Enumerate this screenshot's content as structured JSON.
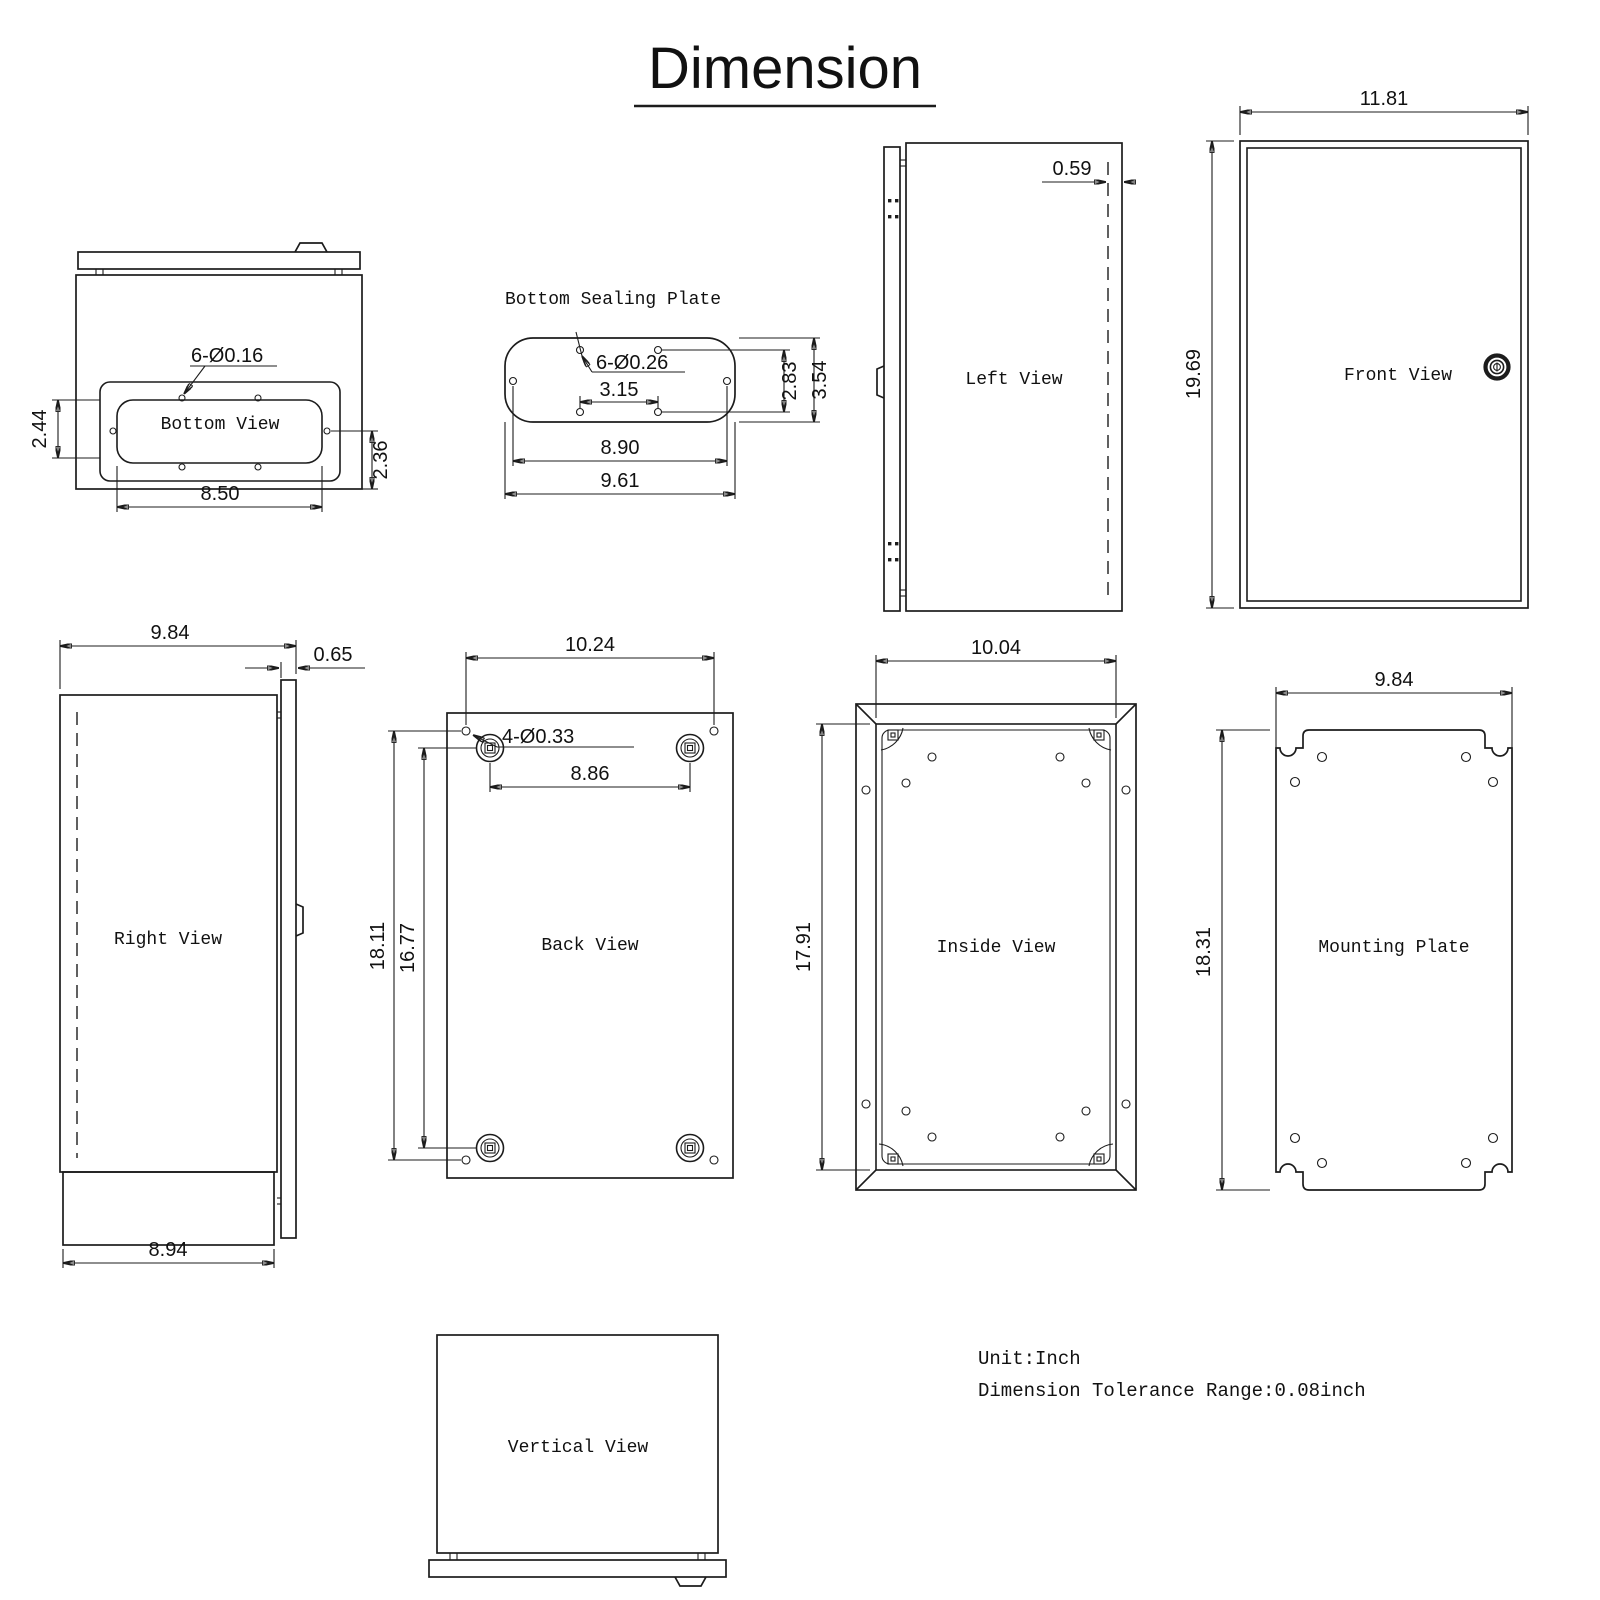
{
  "title": "Dimension",
  "notes": {
    "unit": "Unit:Inch",
    "tolerance": "Dimension Tolerance Range:0.08inch"
  },
  "icons": {
    "front_lock": "cam-lock-icon"
  },
  "views": {
    "bottom_view": {
      "label": "Bottom View",
      "hole_callout": "6-Ø0.16",
      "dim_pocket_height": "2.44",
      "dim_offset": "2.36",
      "dim_width": "8.50"
    },
    "bottom_sealing_plate": {
      "label": "Bottom Sealing Plate",
      "hole_callout": "6-Ø0.26",
      "dim_center_holes": "3.15",
      "dim_hole_span": "8.90",
      "dim_plate_width": "9.61",
      "dim_hole_rows": "2.83",
      "dim_plate_height": "3.54"
    },
    "left_view": {
      "label": "Left View",
      "dim_door_inset": "0.59"
    },
    "front_view": {
      "label": "Front View",
      "dim_width": "11.81",
      "dim_height": "19.69"
    },
    "right_view": {
      "label": "Right View",
      "dim_depth": "9.84",
      "dim_door": "0.65",
      "dim_body_depth": "8.94"
    },
    "back_view": {
      "label": "Back View",
      "hole_callout": "4-Ø0.33",
      "dim_hole_width": "10.24",
      "dim_boss_width": "8.86",
      "dim_hole_height": "18.11",
      "dim_boss_height": "16.77"
    },
    "inside_view": {
      "label": "Inside View",
      "dim_width": "10.04",
      "dim_height": "17.91"
    },
    "mounting_plate": {
      "label": "Mounting Plate",
      "dim_width": "9.84",
      "dim_height": "18.31"
    },
    "vertical_view": {
      "label": "Vertical View"
    }
  }
}
